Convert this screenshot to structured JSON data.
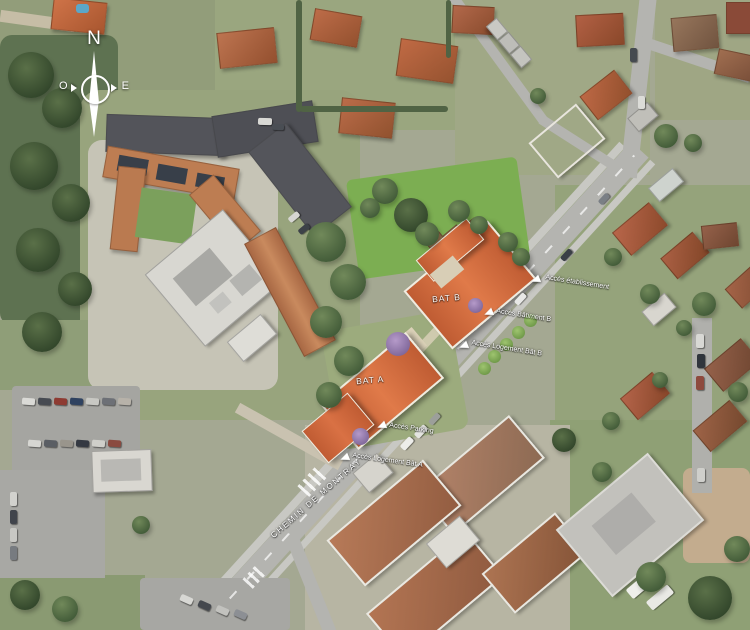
{
  "compass": {
    "north": "N",
    "west": "O",
    "east": "E"
  },
  "site": {
    "buildings": [
      {
        "id": "bat-a",
        "label": "BAT A"
      },
      {
        "id": "bat-b",
        "label": "BAT B"
      }
    ]
  },
  "annotations": {
    "access": [
      {
        "label": "Accès établissement"
      },
      {
        "label": "Accès Bâtiment B"
      },
      {
        "label": "Accès Logement Bât B"
      },
      {
        "label": "Accès Parking"
      },
      {
        "label": "Accès Logement Bât A"
      }
    ],
    "street": {
      "name": "CHEMIN DE MONTRAY"
    }
  },
  "colors": {
    "site_lawn": "#7cae52",
    "new_building_roof": "#d0693f",
    "existing_roof": "#b06246",
    "road": "#b4b4b0",
    "annotation_text": "#ffffff"
  }
}
